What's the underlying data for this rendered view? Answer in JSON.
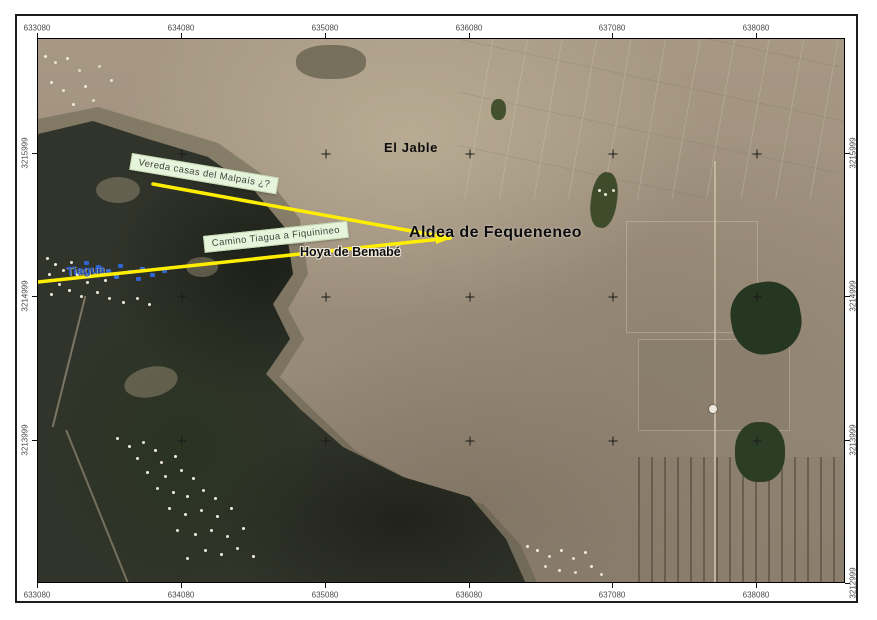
{
  "map_title_context": "georeferenced orthophoto map view",
  "colors": {
    "leader_line": "#ffee00",
    "callout_bg": "#e7f4dc",
    "place_label": "#0d0d0d",
    "blue_label": "#2458c6",
    "frame": "#1c1c1c"
  },
  "graticule": {
    "top": [
      {
        "label": "633080",
        "px": 37
      },
      {
        "label": "634080",
        "px": 181
      },
      {
        "label": "635080",
        "px": 325
      },
      {
        "label": "636080",
        "px": 469
      },
      {
        "label": "637080",
        "px": 612
      },
      {
        "label": "638080",
        "px": 756
      }
    ],
    "bottom": [
      {
        "label": "633080",
        "px": 37
      },
      {
        "label": "634080",
        "px": 181
      },
      {
        "label": "635080",
        "px": 325
      },
      {
        "label": "636080",
        "px": 469
      },
      {
        "label": "637080",
        "px": 612
      },
      {
        "label": "638080",
        "px": 756
      }
    ],
    "left": [
      {
        "label": "3215999",
        "py": 153
      },
      {
        "label": "3214999",
        "py": 296
      },
      {
        "label": "3213999",
        "py": 440
      }
    ],
    "right": [
      {
        "label": "3215999",
        "py": 153
      },
      {
        "label": "3214999",
        "py": 296
      },
      {
        "label": "3213999",
        "py": 440
      },
      {
        "label": "3212999",
        "py": 583
      }
    ],
    "cross_xs": [
      181,
      325,
      469,
      612,
      756
    ],
    "cross_ys": [
      153,
      296,
      440
    ]
  },
  "annotations": {
    "callout_vereda": "Vereda casas del Malpaís ¿?",
    "callout_camino": "Camino Tiagua a Fiquinineo",
    "label_jable": "El Jable",
    "label_aldea": "Aldea de Fequeneneo",
    "label_hoya": "Hoya de Bemabé",
    "label_tiagua": "Tiagua",
    "leader_lines": [
      {
        "x1": 152,
        "y1": 183,
        "x2": 449,
        "y2": 237
      },
      {
        "x1": 37,
        "y1": 281,
        "x2": 449,
        "y2": 237
      }
    ],
    "arrow_tip": {
      "x": 449,
      "y": 237
    }
  }
}
